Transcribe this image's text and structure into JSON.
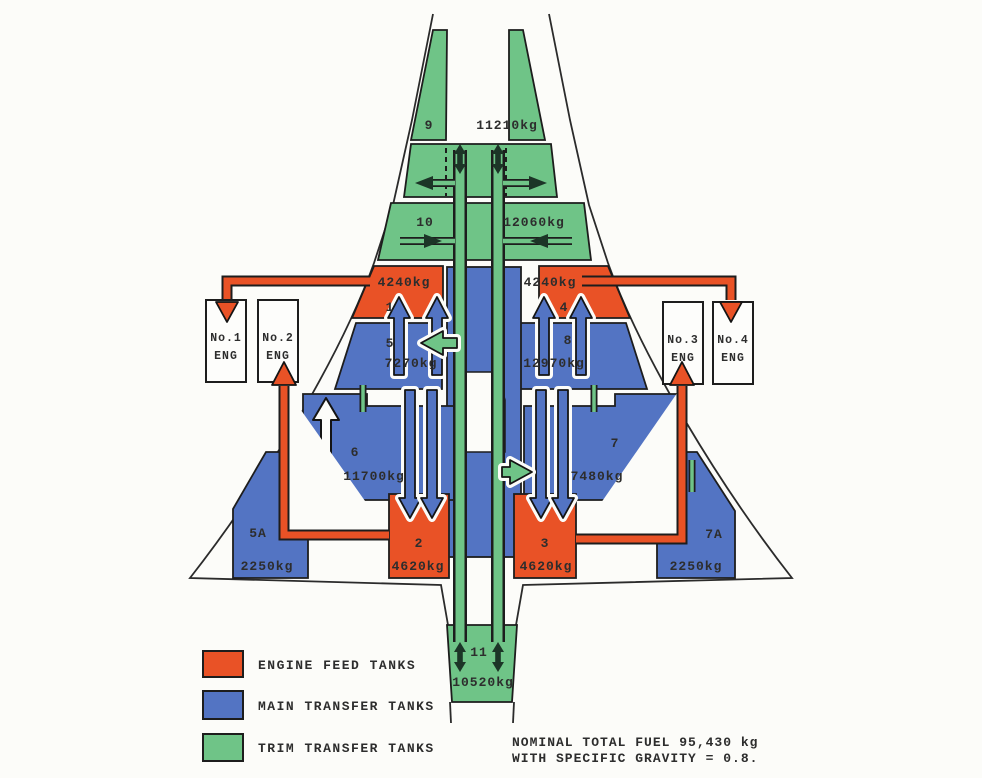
{
  "diagram": {
    "tanks": [
      {
        "num": "9",
        "mass": "11210kg",
        "type": "trim"
      },
      {
        "num": "10",
        "mass": "12060kg",
        "type": "trim"
      },
      {
        "num": "1",
        "mass": "4240kg",
        "type": "feed"
      },
      {
        "num": "4",
        "mass": "4240kg",
        "type": "feed"
      },
      {
        "num": "5",
        "mass": "7270kg",
        "type": "main"
      },
      {
        "num": "8",
        "mass": "12970kg",
        "type": "main"
      },
      {
        "num": "6",
        "mass": "11700kg",
        "type": "main"
      },
      {
        "num": "7",
        "mass": "7480kg",
        "type": "main"
      },
      {
        "num": "2",
        "mass": "4620kg",
        "type": "feed"
      },
      {
        "num": "3",
        "mass": "4620kg",
        "type": "feed"
      },
      {
        "num": "5A",
        "mass": "2250kg",
        "type": "main"
      },
      {
        "num": "7A",
        "mass": "2250kg",
        "type": "main"
      },
      {
        "num": "11",
        "mass": "10520kg",
        "type": "trim"
      }
    ],
    "engines": [
      {
        "line1": "No.1",
        "line2": "ENG"
      },
      {
        "line1": "No.2",
        "line2": "ENG"
      },
      {
        "line1": "No.3",
        "line2": "ENG"
      },
      {
        "line1": "No.4",
        "line2": "ENG"
      }
    ]
  },
  "legend": {
    "items": [
      {
        "label": "ENGINE FEED TANKS",
        "color": "#e95226"
      },
      {
        "label": "MAIN TRANSFER TANKS",
        "color": "#5374c3"
      },
      {
        "label": "TRIM TRANSFER TANKS",
        "color": "#6fc487"
      }
    ]
  },
  "notes": {
    "line1": "NOMINAL TOTAL FUEL 95,430 kg",
    "line2": "WITH SPECIFIC GRAVITY = 0.8."
  },
  "colors": {
    "engine_feed": "#e95226",
    "main_transfer": "#5374c3",
    "trim_transfer": "#6fc487",
    "outline": "#2b2b2b",
    "background": "#fcfcf9"
  }
}
